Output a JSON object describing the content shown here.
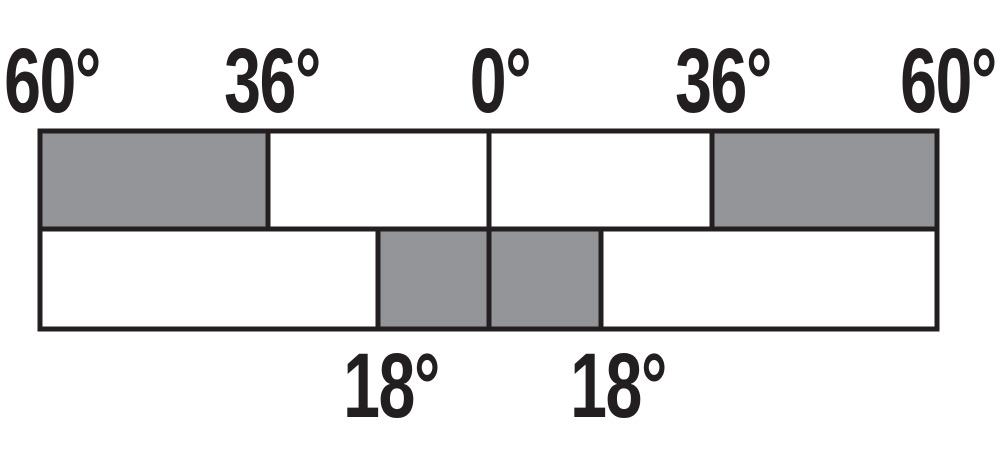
{
  "diagram": {
    "description": "Angle strip diagram with shaded regions",
    "colors": {
      "shaded": "#949598",
      "unshaded": "#ffffff",
      "line": "#231f20",
      "background": "#ffffff"
    },
    "labels": {
      "top": [
        "60°",
        "36°",
        "0°",
        "36°",
        "60°"
      ],
      "bottom": [
        "18°",
        "18°"
      ]
    },
    "rows": [
      {
        "name": "upper-strip",
        "segments": [
          {
            "from": "60° left",
            "to": "36° left",
            "shaded": true
          },
          {
            "from": "36° left",
            "to": "0°",
            "shaded": false
          },
          {
            "from": "0°",
            "to": "36° right",
            "shaded": false
          },
          {
            "from": "36° right",
            "to": "60° right",
            "shaded": true
          }
        ]
      },
      {
        "name": "lower-strip",
        "segments": [
          {
            "from": "60° left",
            "to": "18° left",
            "shaded": false
          },
          {
            "from": "18° left",
            "to": "0°",
            "shaded": true
          },
          {
            "from": "0°",
            "to": "18° right",
            "shaded": true
          },
          {
            "from": "18° right",
            "to": "60° right",
            "shaded": false
          }
        ]
      }
    ]
  }
}
